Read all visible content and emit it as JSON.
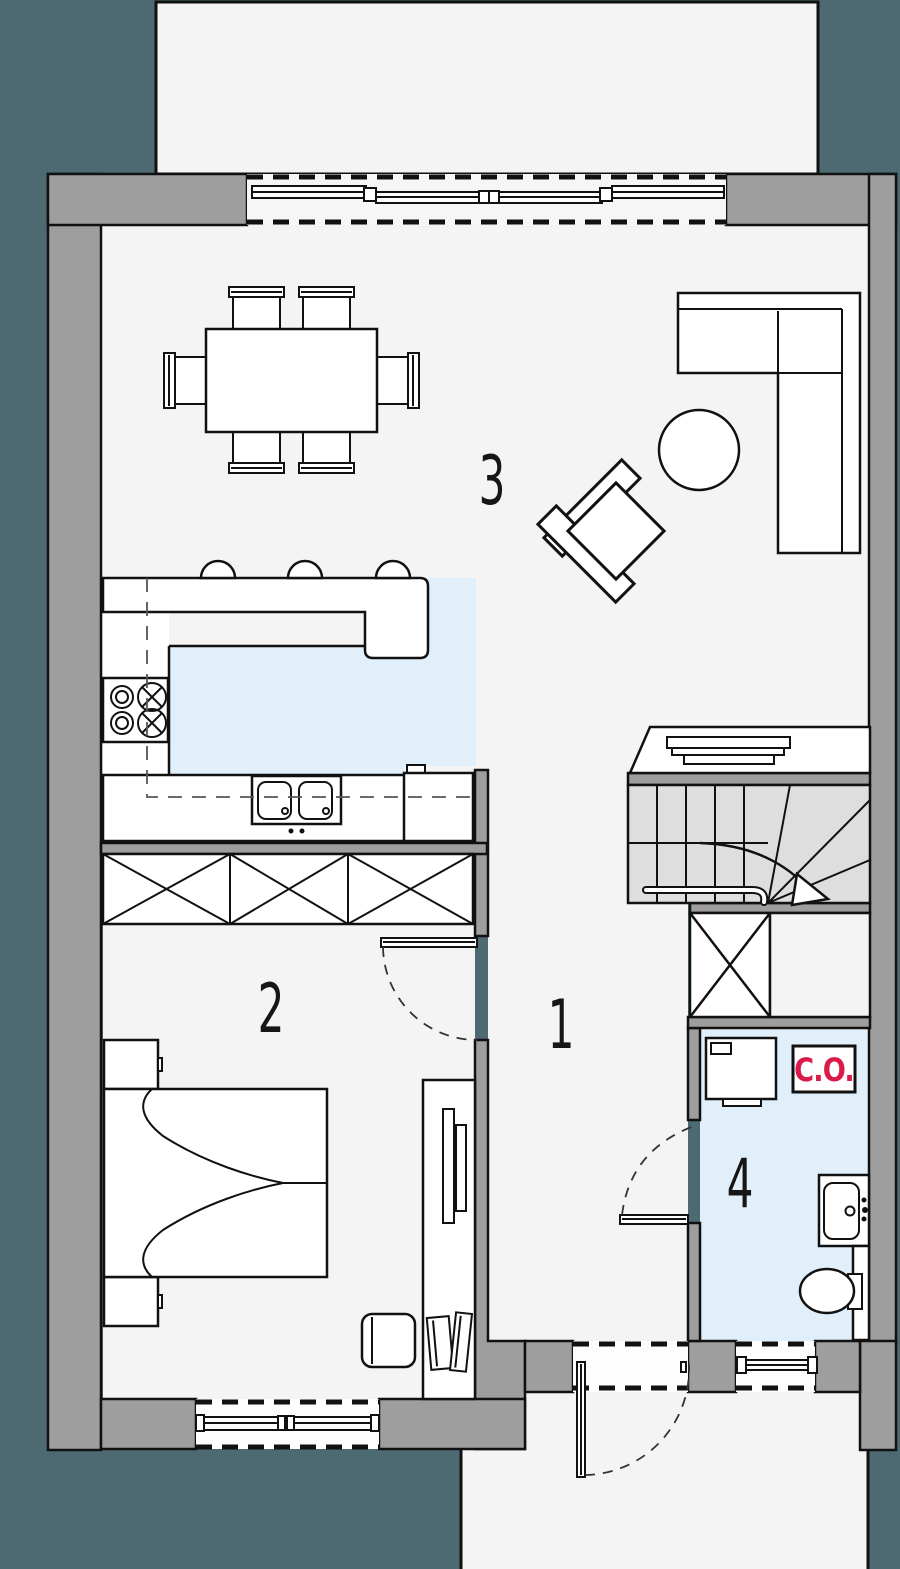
{
  "page": {
    "background_color": "#4d6a73"
  },
  "floor_plan": {
    "rooms": [
      {
        "key": "hallway",
        "number": "1"
      },
      {
        "key": "bedroom",
        "number": "2"
      },
      {
        "key": "living-room-kitchen",
        "number": "3"
      },
      {
        "key": "bathroom",
        "number": "4"
      }
    ],
    "labels": {
      "central_heating": "C.O."
    },
    "colors": {
      "background": "#4d6a73",
      "walls": "#9e9e9e",
      "floor": "#f4f4f4",
      "kitchen_floor": "#e1effb",
      "bathroom_floor": "#e1effb",
      "stairs": "#dedede",
      "outline": "#111111",
      "heating_label_red": "#dc1a4a"
    }
  }
}
